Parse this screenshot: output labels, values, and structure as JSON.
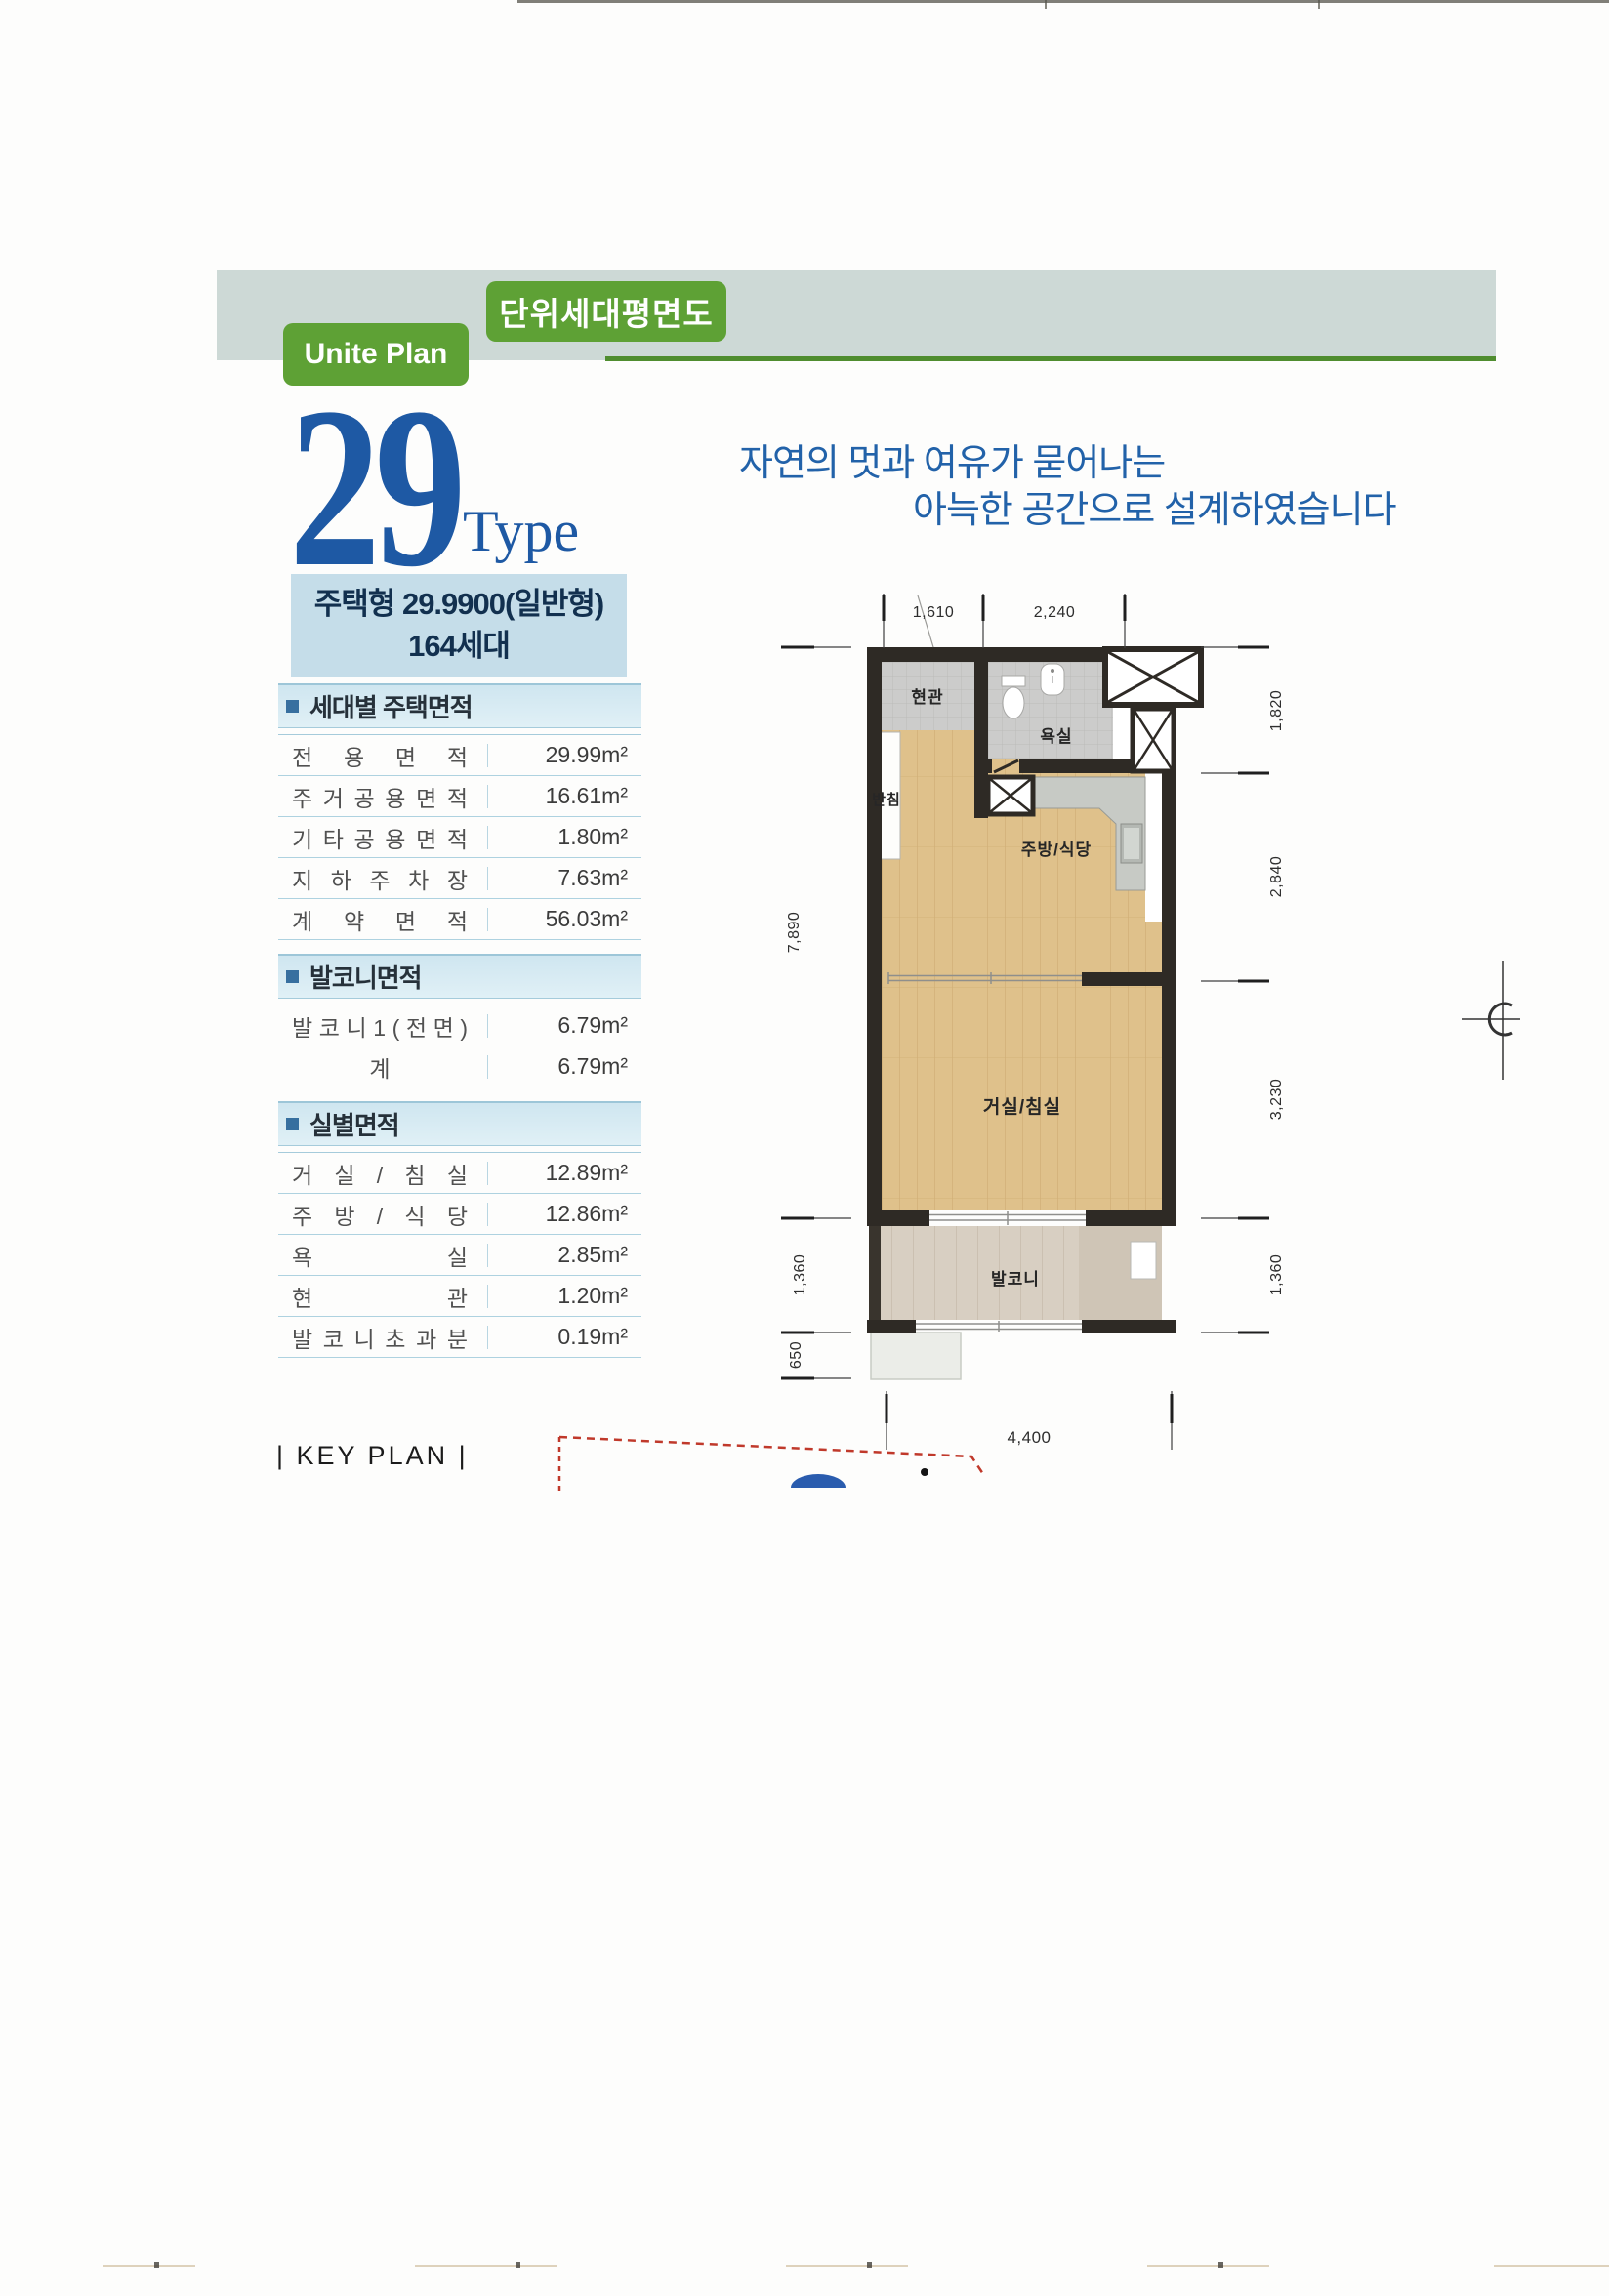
{
  "header": {
    "tab_label": "단위세대평면도",
    "plan_label": "Unite Plan"
  },
  "title": {
    "number": "29",
    "suffix": "Type",
    "headline_line1": "자연의 멋과 여유가 묻어나는",
    "headline_line2": "아늑한 공간으로 설계하였습니다"
  },
  "type_box": {
    "line1": "주택형 29.9900(일반형)",
    "line2": "164세대"
  },
  "tables": [
    {
      "section": "세대별 주택면적",
      "rows": [
        {
          "label": "전 용 면 적",
          "value": "29.99m²"
        },
        {
          "label": "주 거 공 용 면 적",
          "value": "16.61m²"
        },
        {
          "label": "기 타 공 용 면 적",
          "value": "1.80m²"
        },
        {
          "label": "지 하 주 차 장",
          "value": "7.63m²"
        },
        {
          "label": "계 약 면 적",
          "value": "56.03m²"
        }
      ]
    },
    {
      "section": "발코니면적",
      "rows": [
        {
          "label": "발 코 니 1 ( 전 면 )",
          "value": "6.79m²"
        },
        {
          "label": "계",
          "value": "6.79m²",
          "center": true
        }
      ]
    },
    {
      "section": "실별면적",
      "rows": [
        {
          "label": "거 실 / 침 실",
          "value": "12.89m²"
        },
        {
          "label": "주 방 / 식 당",
          "value": "12.86m²"
        },
        {
          "label": "욕 실",
          "value": "2.85m²"
        },
        {
          "label": "현 관",
          "value": "1.20m²"
        },
        {
          "label": "발 코 니 초 과 분",
          "value": "0.19m²"
        }
      ]
    }
  ],
  "floor_plan": {
    "rooms": {
      "entrance": "현관",
      "bath": "욕실",
      "closet": "반침",
      "kitchen": "주방/식당",
      "living": "거실/침실",
      "balcony": "발코니"
    },
    "dimensions": {
      "top": [
        "1,610",
        "2,240"
      ],
      "right": [
        "1,820",
        "2,840",
        "3,230",
        "1,360"
      ],
      "left": [
        "7,890",
        "1,360",
        "650"
      ],
      "bottom": "4,400"
    }
  },
  "key_plan": {
    "label": "| KEY PLAN |"
  },
  "colors": {
    "accent_green": "#5ea135",
    "band_gray": "#cdd9d6",
    "title_blue": "#1e59a4",
    "headline_blue": "#2262a9",
    "type_box_bg": "#c5dde9",
    "section_band_bg": "#cfe6f0",
    "wall_dark": "#2e2a25",
    "wood_floor": "#dfc18b",
    "tile_gray": "#cccccb",
    "balcony_floor": "#d8cfc2",
    "keyplan_red": "#c0392b"
  }
}
